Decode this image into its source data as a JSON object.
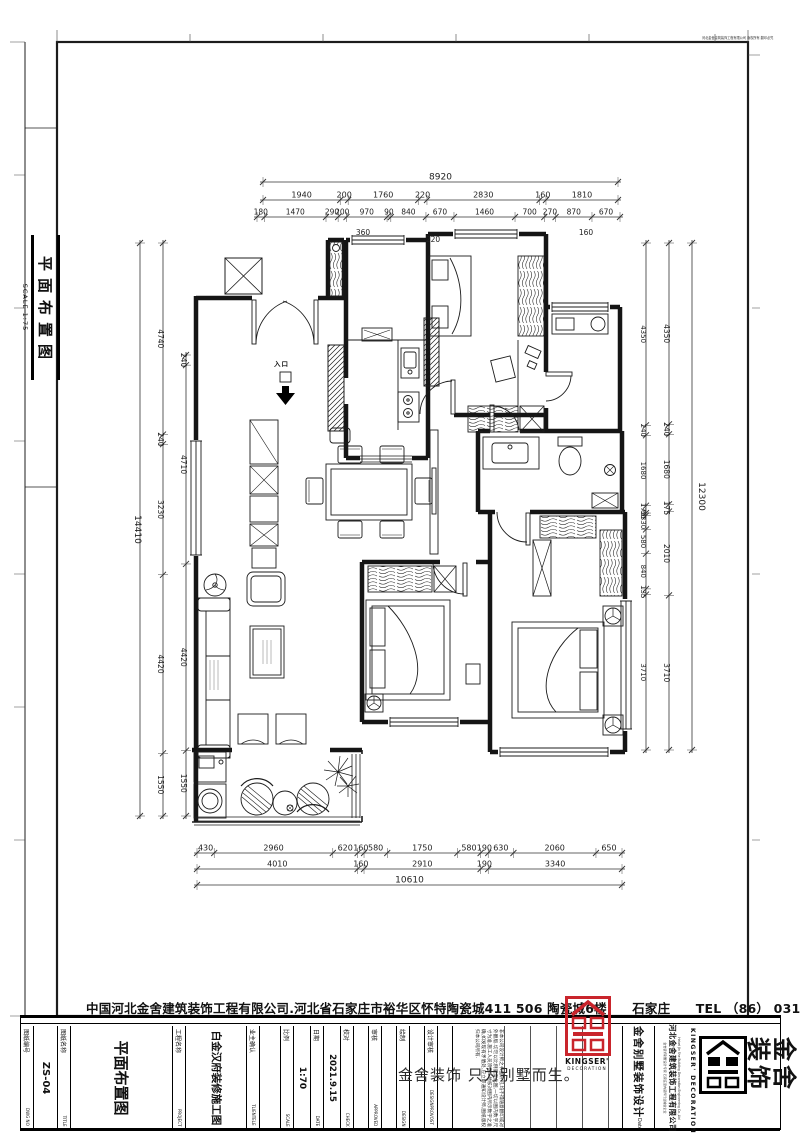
{
  "sheet": {
    "bg": "#ffffff",
    "line_color": "#1c1c1c",
    "accent_red": "#c9252c",
    "micro_print": "河北金舍建筑装饰工程有限公司 版权所有 翻印必究"
  },
  "sidebar": {
    "title": "平面布置图",
    "scale_label": "SCALE 1:75"
  },
  "plan": {
    "entry_label": "入口"
  },
  "dimensions": {
    "top_total": {
      "values": [
        "8920"
      ]
    },
    "top_row2": {
      "values": [
        "1940",
        "200",
        "1760",
        "220",
        "2830",
        "160",
        "1810"
      ]
    },
    "top_row3": {
      "values": [
        "180",
        "1470",
        "290",
        "200",
        "970",
        "90",
        "840",
        "670",
        "1460",
        "700",
        "270",
        "870",
        "670"
      ]
    },
    "top_sub": [
      "360",
      "220",
      "160"
    ],
    "left_total": {
      "values": [
        "14410"
      ]
    },
    "left_inner": {
      "values": [
        "4740",
        "240",
        "3230",
        "4420",
        "1550"
      ]
    },
    "left_inner2": {
      "values": [
        "240",
        "4710",
        "4420",
        "1550"
      ]
    },
    "right_total": {
      "values": [
        "12300"
      ]
    },
    "right_mid": {
      "values": [
        "4350",
        "240",
        "1680",
        "175",
        "2010",
        "3710"
      ]
    },
    "right_inner": {
      "values": [
        "4350",
        "240",
        "1680",
        "175",
        "60",
        "330",
        "580",
        "840",
        "135",
        "3710"
      ]
    },
    "bottom_row1": {
      "values": [
        "430",
        "2960",
        "620",
        "160",
        "580",
        "1750",
        "580",
        "190",
        "630",
        "2060",
        "650"
      ]
    },
    "bottom_row2": {
      "values": [
        "4010",
        "160",
        "2910",
        "190",
        "3340"
      ]
    },
    "bottom_total": {
      "values": [
        "10610"
      ]
    }
  },
  "footer": {
    "company_line": "中国河北金舍建筑装饰工程有限公司.河北省石家庄市裕华区怀特陶瓷城411 506 陶瓷城6楼　　石家庄　　TEL （86） 0311-88995555"
  },
  "titleblock": {
    "columns": [
      {
        "label": "图纸编号",
        "value": "ZS-04",
        "en": "DWG NO"
      },
      {
        "label": "图纸名称",
        "value": "平面布置图",
        "en": "TITLE"
      },
      {
        "label": "工程名称",
        "value": "白金汉府装修施工图",
        "en": "PROJECT"
      },
      {
        "label": "业主确认",
        "value": "",
        "en": "TLIENTELE"
      },
      {
        "label": "比例",
        "value": "1:70",
        "en": "SCALE"
      },
      {
        "label": "日期",
        "value": "2021.9.15",
        "en": "DATE"
      },
      {
        "label": "校对",
        "value": "",
        "en": "CHECK"
      },
      {
        "label": "审核",
        "value": "",
        "en": "APPROVED"
      },
      {
        "label": "绘制",
        "value": "",
        "en": "DESIGN"
      },
      {
        "label": "设计审核",
        "value": "",
        "en": "DESIGNPROVOST"
      }
    ],
    "notes": "非本公司设计师之书面许可,均不得随意翻印或对外翻版.切勿以比例量度此图,一切以图内数字尺寸为准.施工人员须在工地核对图内所示数字之准确,如发现有矛盾处,应立即通知设计师,图纸版权归本公司所有.",
    "watermark": "金舍装饰 只为别墅而生。",
    "brand_column": "金舍别墅装饰设计",
    "brand_date": "Date",
    "company_column": "河北金舍建筑装饰工程有限公司",
    "company_column_en": "Hebei Jin She Building Decoration Engineering Co.,Ltd",
    "company_column_cn2": "金舍装饰别墅设计专家 石家庄室内装饰行业诚信企业",
    "kingser": "KINGSER'",
    "decoration": "DECORATION",
    "kingser_vertical": "KINGSER' DECORATION",
    "big_brand_line1": "金舍",
    "big_brand_line2": "装饰"
  }
}
